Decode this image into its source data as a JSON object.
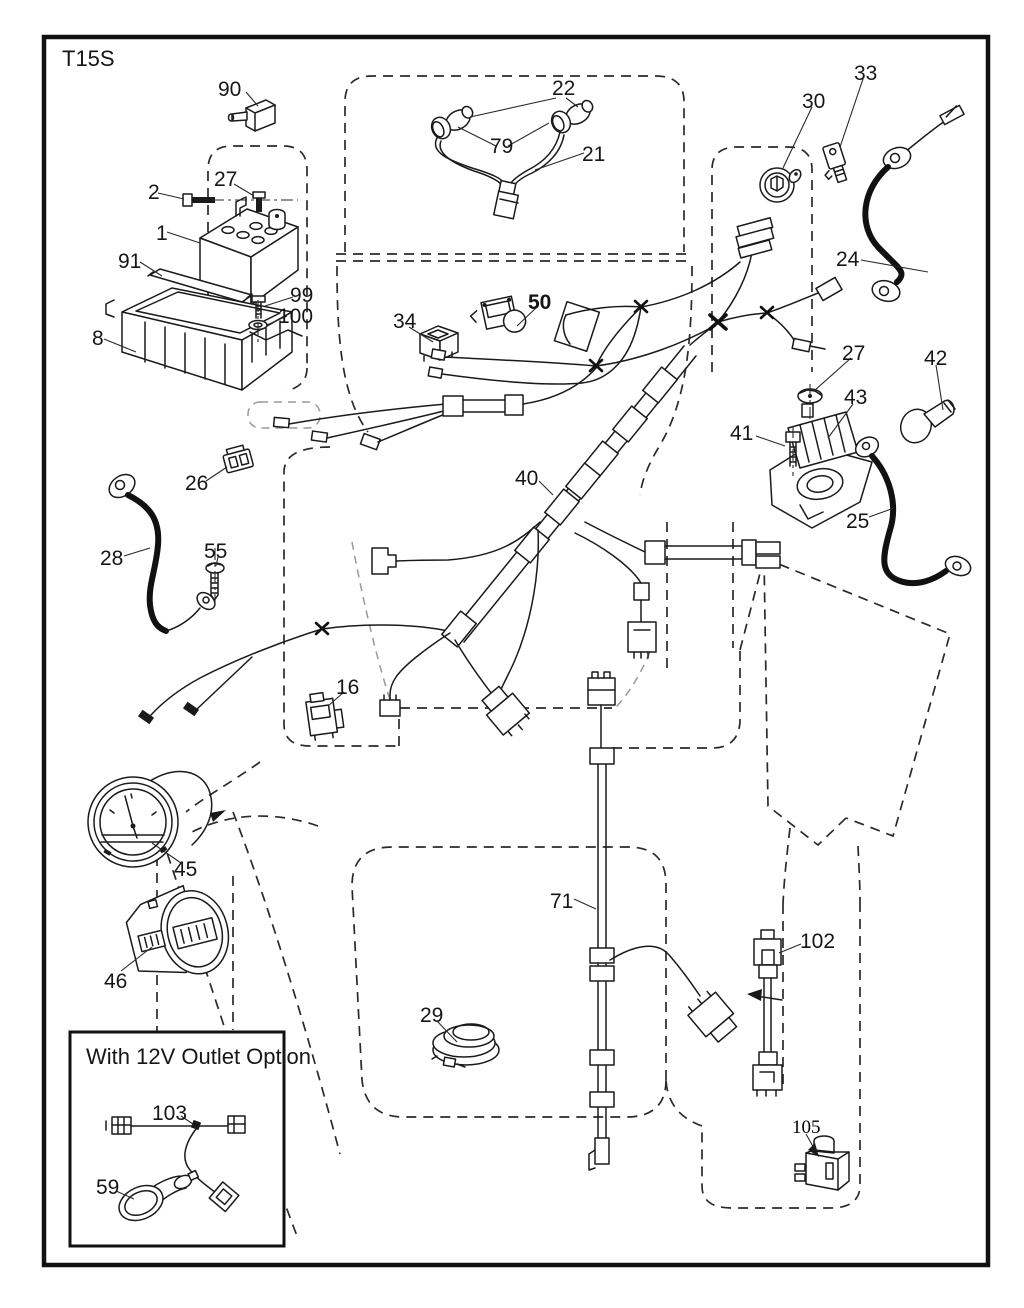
{
  "page": {
    "title": "T15S",
    "background": "#ffffff",
    "line_color": "#1a1a1a"
  },
  "inset": {
    "title": "With 12V Outlet Option"
  },
  "labels": {
    "l90": "90",
    "l2": "2",
    "l27a": "27",
    "l1": "1",
    "l91": "91",
    "l99": "99",
    "l100": "100",
    "l8": "8",
    "l22": "22",
    "l79": "79",
    "l21": "21",
    "l30": "30",
    "l33": "33",
    "l24": "24",
    "l34": "34",
    "l50": "50",
    "l27b": "27",
    "l42": "42",
    "l43": "43",
    "l41": "41",
    "l25": "25",
    "l26": "26",
    "l40": "40",
    "l28": "28",
    "l55": "55",
    "l16": "16",
    "l45": "45",
    "l46": "46",
    "l71": "71",
    "l29": "29",
    "l102": "102",
    "l103": "103",
    "l59": "59",
    "l105": "105"
  }
}
